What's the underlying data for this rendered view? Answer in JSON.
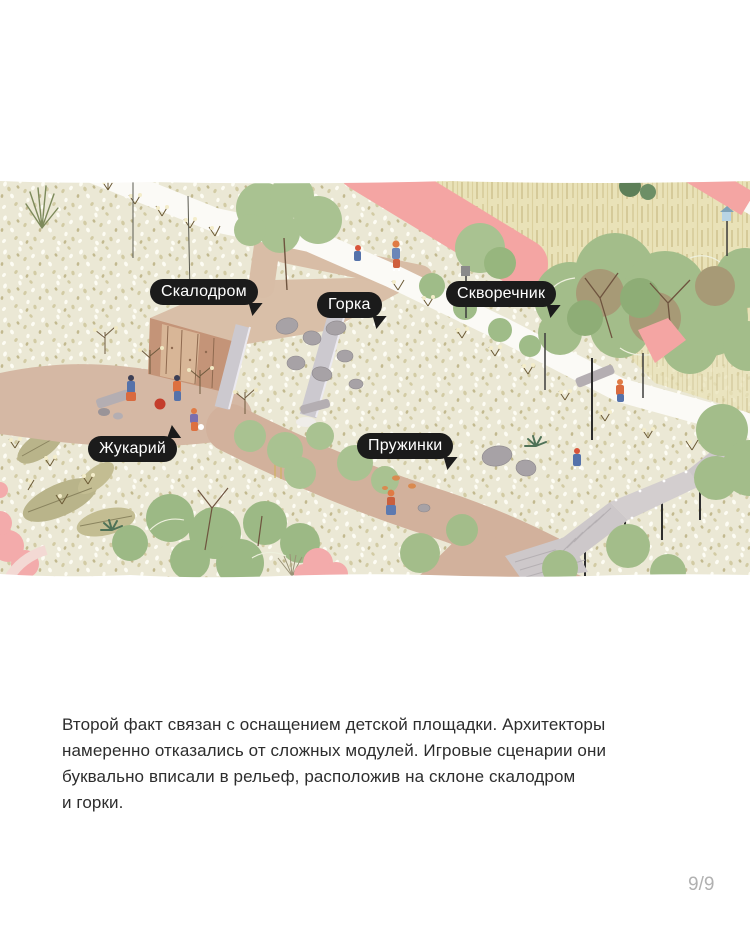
{
  "map": {
    "labels": [
      {
        "text": "Скалодром"
      },
      {
        "text": "Горка"
      },
      {
        "text": "Скворечник"
      },
      {
        "text": "Жукарий"
      },
      {
        "text": "Пружинки"
      }
    ]
  },
  "caption": {
    "lines": [
      "Второй факт связан с оснащением детской площадки. Архитекторы",
      "намеренно отказались от сложных модулей. Игровые сценарии они",
      "буквально вписали в рельеф, расположив на склоне скалодром",
      "и горки."
    ]
  },
  "pagination": {
    "current": "9",
    "total": "9",
    "display": "9/9"
  },
  "colors": {
    "label_bubble": "#1b1b1b",
    "label_text": "#ffffff",
    "road_pink": "#f4a5a3",
    "ground_cream": "#ebe8d5",
    "dirt_tan": "#d5b8a4",
    "tree_green": "#a3bd8a",
    "caption_text": "#2d2d2d",
    "page_indicator": "#b1b1b1"
  }
}
